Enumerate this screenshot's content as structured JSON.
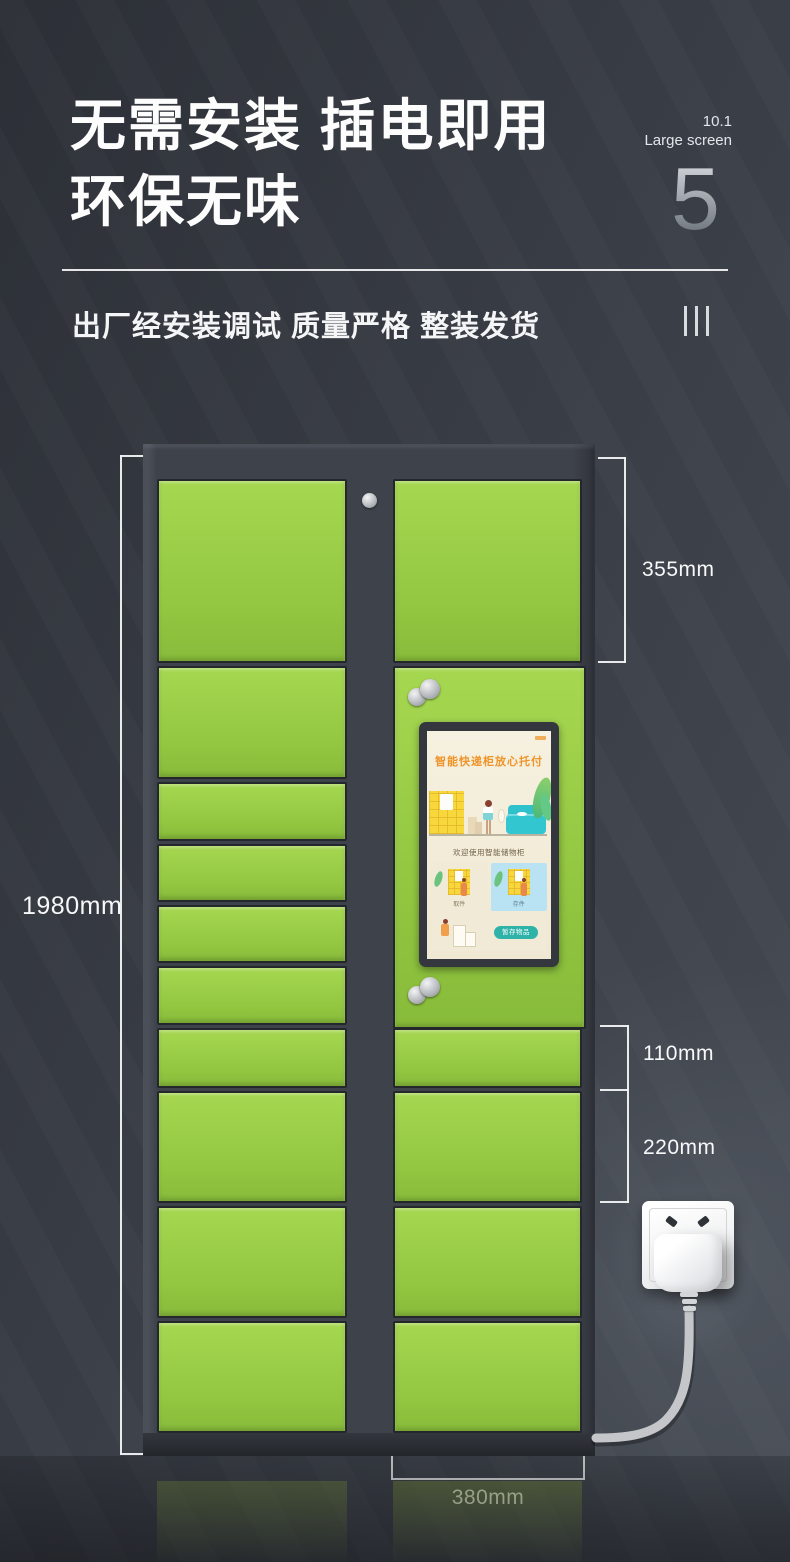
{
  "header": {
    "title_line1": "无需安装 插电即用",
    "title_line2": "环保无味",
    "screen_size": "10.1",
    "screen_size_label": "Large screen",
    "page_number": "5",
    "subtitle": "出厂经安装调试 质量严格 整装发货"
  },
  "dimensions": {
    "overall_height": "1980mm",
    "large_door": "355mm",
    "small_door": "110mm",
    "medium_door": "220mm",
    "door_width": "380mm"
  },
  "locker_screen": {
    "title": "智能快递柜放心托付",
    "welcome": "欢迎使用智能储物柜",
    "card_pickup": "取件",
    "card_deposit": "存件",
    "store_button": "暂存物品"
  },
  "colors": {
    "door_green": "#9bcf47",
    "cabinet_gray": "#3e424b",
    "screen_accent_orange": "#ef9429",
    "screen_teal": "#2fb3a8",
    "background": "#383c44"
  }
}
